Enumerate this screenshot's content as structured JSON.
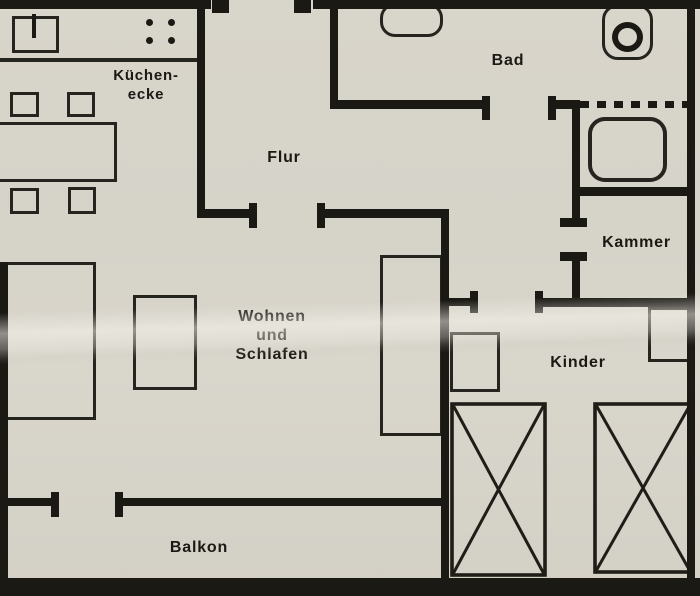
{
  "rooms": {
    "kueche": {
      "line1": "Küchen-",
      "line2": "ecke"
    },
    "flur": {
      "label": "Flur"
    },
    "bad": {
      "label": "Bad"
    },
    "kammer": {
      "label": "Kammer"
    },
    "wohnen": {
      "line1": "Wohnen",
      "line2": "und",
      "line3": "Schlafen"
    },
    "kinder": {
      "label": "Kinder"
    },
    "balkon": {
      "label": "Balkon"
    }
  },
  "colors": {
    "paper": "#d8d5cb",
    "ink": "#1b1914",
    "crease_highlight": "#f0eee6"
  },
  "fixtures": [
    "kitchen-sink",
    "stove-burners",
    "dining-table",
    "chair",
    "sofa-bed",
    "side-table",
    "wardrobe",
    "washbasin",
    "toilet",
    "bathtub",
    "cabinet",
    "crossed-bed"
  ]
}
